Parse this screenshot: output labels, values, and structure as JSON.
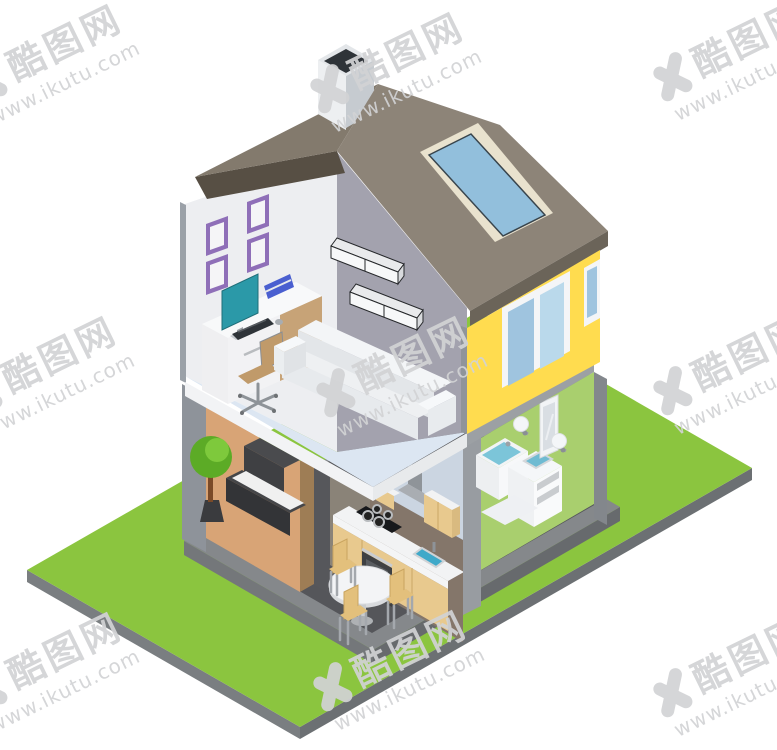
{
  "image": {
    "width": 777,
    "height": 750,
    "background": "#ffffff",
    "subject": "isometric-two-story-house-cutaway-illustration"
  },
  "watermark": {
    "logo_icon": "x-logo-icon",
    "site_name": "酷图网",
    "site_url": "www.ikutu.com",
    "color": "#d2d3d5",
    "rotation_deg": -26,
    "positions": [
      {
        "x": 50,
        "y": 62
      },
      {
        "x": 392,
        "y": 70
      },
      {
        "x": 735,
        "y": 58
      },
      {
        "x": 45,
        "y": 374
      },
      {
        "x": 398,
        "y": 374
      },
      {
        "x": 735,
        "y": 372
      },
      {
        "x": 50,
        "y": 670
      },
      {
        "x": 395,
        "y": 668
      },
      {
        "x": 735,
        "y": 674
      }
    ]
  },
  "scene": {
    "rooms": [
      "home-office",
      "living-room",
      "bedroom",
      "kitchen",
      "bathroom"
    ],
    "exterior": [
      "lawn",
      "roof",
      "chimney",
      "skylight",
      "yellow-wall",
      "windows",
      "base-platform"
    ]
  },
  "colors": {
    "lawn": "#8BC53F",
    "lawn_edge": "#7A7E81",
    "lawn_edge_dark": "#6C7073",
    "platform": "#85888B",
    "platform_left": "#74777A",
    "platform_right": "#676A6D",
    "floor_dark": "#55565A",
    "wall_tan": "#D8A476",
    "wall_hall": "#8A8378",
    "wall_kitchen": "#84766A",
    "wall_green": "#A9CF6E",
    "attic_wall_gray": "#A3A2AE",
    "attic_wall_white": "#EDEEF1",
    "floor_upper": "#DCE6F2",
    "slab_white": "#F2F3F5",
    "slab_gray": "#9CA0A4",
    "ceiling_blue": "#CBD5E1",
    "roof_left": "#837A6D",
    "roof_right": "#8D8478",
    "roof_underside": "#574F44",
    "fascia": "#6B6459",
    "chimney_light": "#EDEFF1",
    "chimney_shade": "#C6CBD0",
    "chimney_top": "#E3E6E9",
    "chimney_hole": "#2E3338",
    "skylight_frame": "#E9E2CE",
    "skylight_glass": "#92BFDC",
    "wall_yellow": "#FFDC4F",
    "window_frame": "#F4F5F7",
    "window_glass_left": "#9FC4DF",
    "window_glass_right": "#BAD9EB",
    "frame_purple": "#8F6FB8",
    "desk_tan": "#C7A377",
    "monitor_teal": "#2B99A8",
    "book_blue": "#4A5FD0",
    "chair_tan": "#C09A6A",
    "sofa_white": "#EEF0F2",
    "bed_dark": "#3F4043",
    "mattress": "#F0F0F0",
    "tree_green": "#5CAB26",
    "tree_light": "#7EC93C",
    "trunk_brown": "#7A4A28",
    "pot_dark": "#3A3B3E",
    "cabinet_tan": "#E8C98E",
    "counter_white": "#F2F3F4",
    "oven_dark": "#3E4043",
    "cooktop_black": "#17191C",
    "sink_water": "#3FA9C9",
    "tub_water": "#7CC5D9",
    "column_gray": "#989CA1"
  }
}
